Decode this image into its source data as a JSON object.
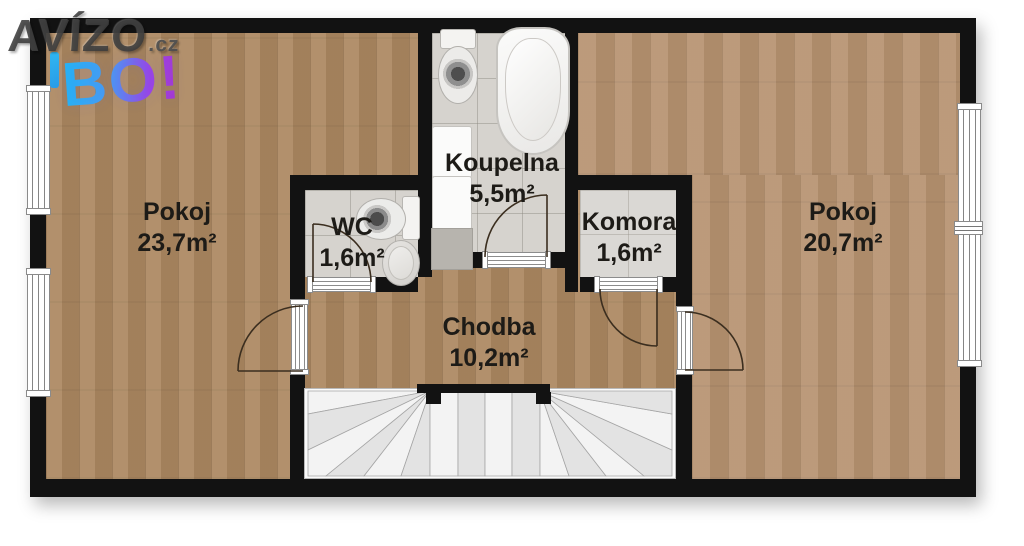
{
  "logo": {
    "site": "AVÍZO",
    "tld": ".cz",
    "badge": "BO!"
  },
  "rooms": [
    {
      "name": "Pokoj",
      "area": "23,7m²"
    },
    {
      "name": "WC",
      "area": "1,6m²"
    },
    {
      "name": "Koupelna",
      "area": "5,5m²"
    },
    {
      "name": "Komora",
      "area": "1,6m²"
    },
    {
      "name": "Pokoj",
      "area": "20,7m²"
    },
    {
      "name": "Chodba",
      "area": "10,2m²"
    }
  ],
  "colors": {
    "wall": "#121212",
    "wood_left_room": "#ac8861",
    "wood_right_room": "#b69270",
    "tile_bathroom": "#d6d3ce",
    "tile_storage": "#dad8d4",
    "stair_tread": "#f0f0f0",
    "label_text": "#1d1b17",
    "logo_gray": "#3c3c3c",
    "logo_blue": "#27b4f5",
    "logo_purple": "#a838cf"
  }
}
